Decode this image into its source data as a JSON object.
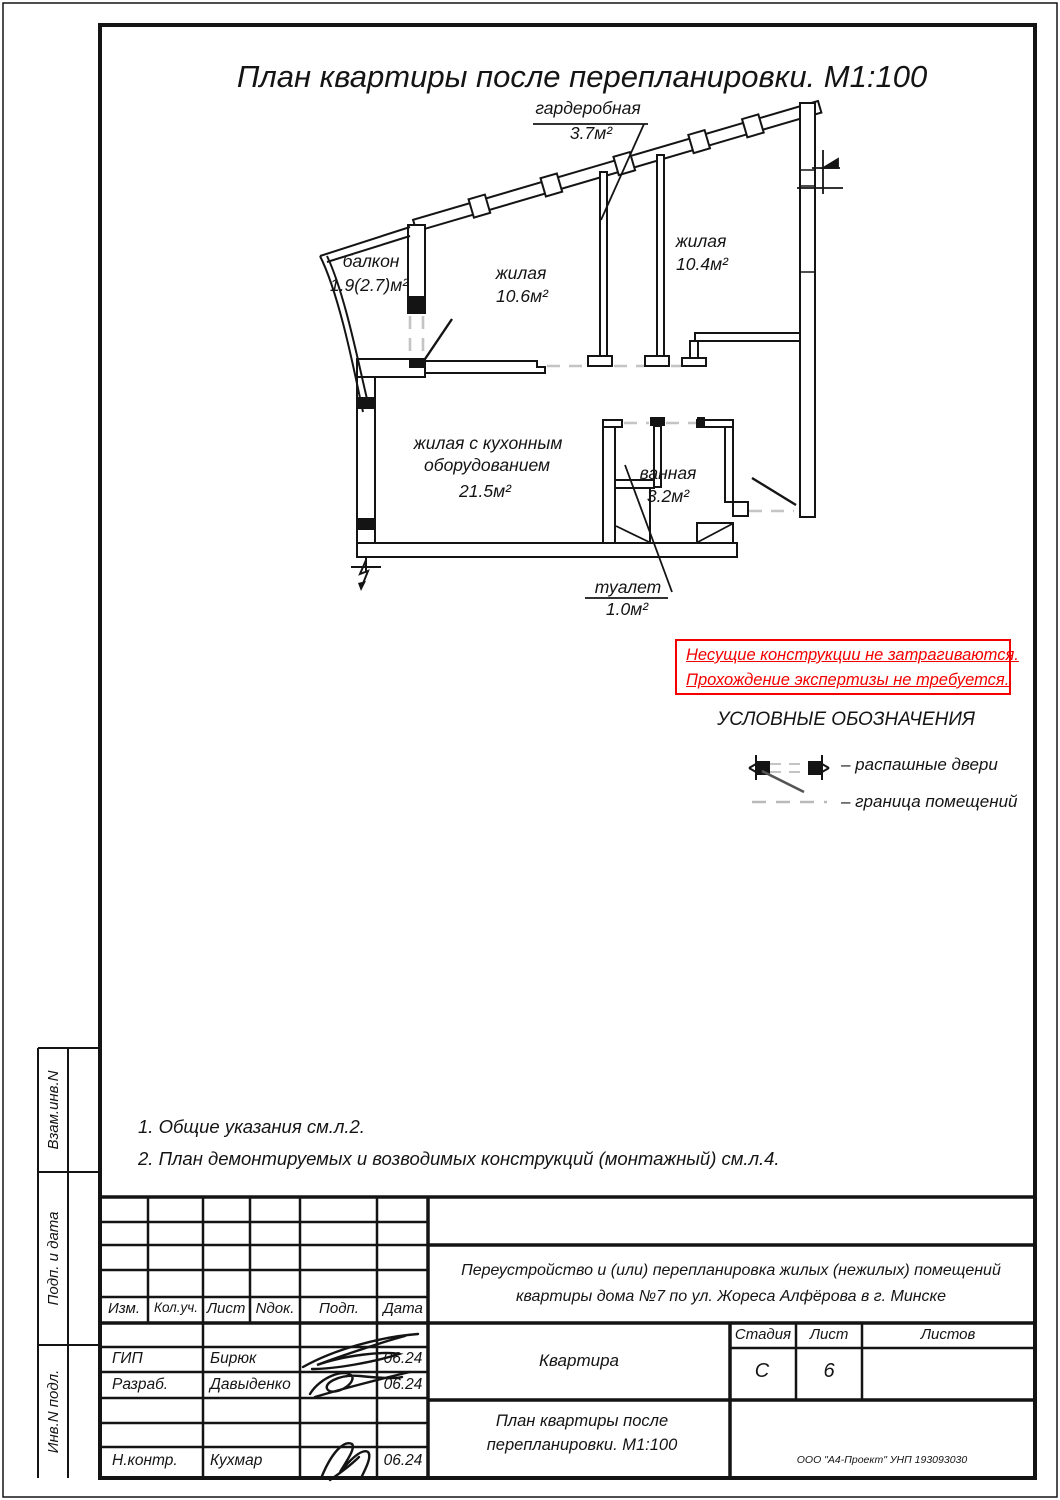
{
  "page": {
    "title": "План квартиры после перепланировки. М1:100"
  },
  "plan": {
    "rooms": {
      "balcony": {
        "name": "балкон",
        "area": "1.9(2.7)м²"
      },
      "living1": {
        "name": "жилая",
        "area": "10.6м²"
      },
      "living2": {
        "name": "жилая",
        "area": "10.4м²"
      },
      "wardrobe": {
        "name": "гардеробная",
        "area": "3.7м²"
      },
      "kitchen_living": {
        "name": "жилая с кухонным",
        "name2": "оборудованием",
        "area": "21.5м²"
      },
      "bathroom": {
        "name": "ванная",
        "area": "3.2м²"
      },
      "toilet": {
        "name": "туалет",
        "area": "1.0м²"
      }
    }
  },
  "warning": {
    "line1": "Несущие конструкции не затрагиваются.",
    "line2": "Прохождение экспертизы не требуется.",
    "color": "#f40000"
  },
  "legend": {
    "title": "УСЛОВНЫЕ ОБОЗНАЧЕНИЯ",
    "door_label": "–  распашные двери",
    "boundary_label": "–  граница помещений"
  },
  "notes": {
    "n1": "1. Общие указания см.л.2.",
    "n2": "2. План демонтируемых и возводимых конструкций (монтажный) см.л.4."
  },
  "side_stamp": {
    "c1": "Взам.инв.N",
    "c2": "Подп. и дата",
    "c3": "Инв.N подл."
  },
  "title_block": {
    "cols": {
      "c1": "Изм.",
      "c2": "Кол.уч.",
      "c3": "Лист",
      "c4": "Nдок.",
      "c5": "Подп.",
      "c6": "Дата"
    },
    "rows": {
      "gip": {
        "role": "ГИП",
        "name": "Бирюк",
        "date": "06.24"
      },
      "razrab": {
        "role": "Разраб.",
        "name": "Давыденко",
        "date": "06.24"
      },
      "nkontr": {
        "role": "Н.контр.",
        "name": "Кухмар",
        "date": "06.24"
      }
    },
    "project": {
      "line1": "Переустройство и (или) перепланировка жилых (нежилых) помещений",
      "line2": "квартиры дома №7 по ул. Жореса Алфёрова в г. Минске"
    },
    "object_name": "Квартира",
    "stage": {
      "label": "Стадия",
      "value": "С"
    },
    "sheet": {
      "label": "Лист",
      "value": "6"
    },
    "sheets": {
      "label": "Листов",
      "value": ""
    },
    "drawing": {
      "line1": "План квартиры после",
      "line2": "перепланировки. М1:100"
    },
    "company": "ООО \"А4-Проект\" УНП 193093030"
  }
}
